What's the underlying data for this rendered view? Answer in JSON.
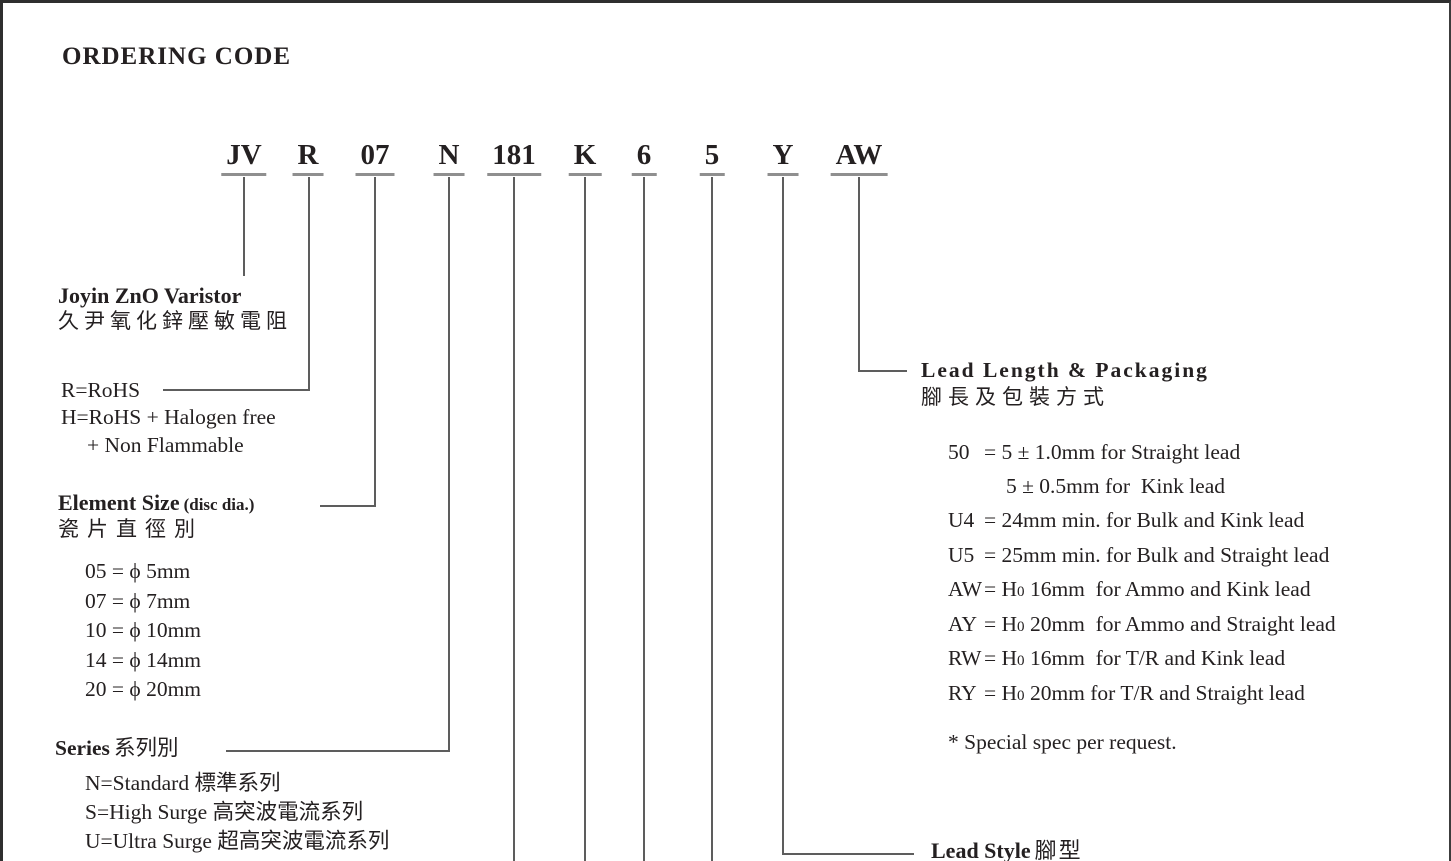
{
  "title": "ORDERING CODE",
  "code": {
    "segments": [
      {
        "label": "JV"
      },
      {
        "label": "R"
      },
      {
        "label": "07"
      },
      {
        "label": "N"
      },
      {
        "label": "181"
      },
      {
        "label": "K"
      },
      {
        "label": "6"
      },
      {
        "label": "5"
      },
      {
        "label": "Y"
      },
      {
        "label": "AW"
      }
    ]
  },
  "brand": {
    "en": "Joyin ZnO Varistor",
    "zh": "久尹氧化鋅壓敏電阻"
  },
  "rohs": {
    "line1": "R=RoHS",
    "line2": "H=RoHS + Halogen free",
    "line3": "+ Non Flammable"
  },
  "element_size": {
    "title": "Element Size",
    "subtitle": "(disc dia.)",
    "zh": "瓷片直徑別",
    "options": [
      "05 = ϕ 5mm",
      "07 = ϕ 7mm",
      "10 = ϕ 10mm",
      "14 = ϕ 14mm",
      "20 = ϕ 20mm"
    ]
  },
  "series": {
    "title": "Series",
    "zh": "系列別",
    "options": [
      "N=Standard 標準系列",
      "S=High Surge 高突波電流系列",
      "U=Ultra Surge 超高突波電流系列"
    ]
  },
  "lead_length": {
    "title": "Lead Length & Packaging",
    "zh": "腳長及包裝方式",
    "rows": [
      {
        "code": "50",
        "pre": "= 5 ± 1.0mm for Straight lead",
        "h0": "",
        "rest": ""
      },
      {
        "code": "",
        "pre": "5 ± 0.5mm for  Kink lead",
        "h0": "",
        "rest": ""
      },
      {
        "code": "U4",
        "pre": "= 24mm min. for Bulk and Kink lead",
        "h0": "",
        "rest": ""
      },
      {
        "code": "U5",
        "pre": "= 25mm min. for Bulk and Straight lead",
        "h0": "",
        "rest": ""
      },
      {
        "code": "AW",
        "pre": "= H",
        "h0": "0",
        "rest": " 16mm  for Ammo and Kink lead"
      },
      {
        "code": "AY",
        "pre": "= H",
        "h0": "0",
        "rest": " 20mm  for Ammo and Straight lead"
      },
      {
        "code": "RW",
        "pre": "= H",
        "h0": "0",
        "rest": " 16mm  for T/R and Kink lead"
      },
      {
        "code": "RY",
        "pre": "= H",
        "h0": "0",
        "rest": " 20mm for T/R and Straight lead"
      }
    ],
    "note": "* Special spec per request."
  },
  "lead_style": {
    "title": "Lead Style",
    "zh": "腳型"
  }
}
